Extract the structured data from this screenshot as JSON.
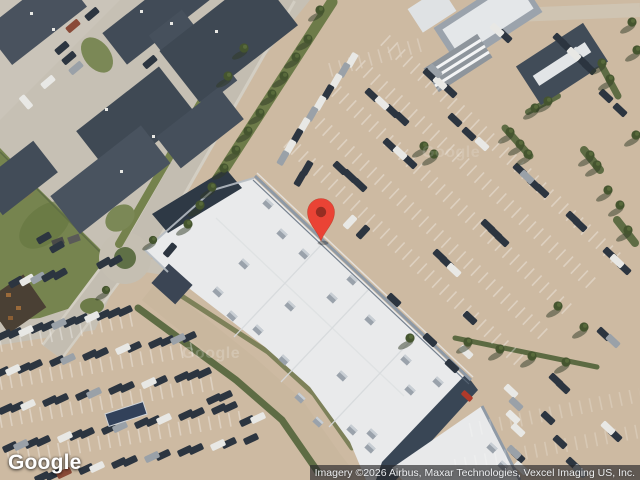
{
  "map": {
    "logo": {
      "text": "Google"
    },
    "watermark_text": "Google",
    "attribution": {
      "text": "Imagery ©2026 Airbus, Maxar Technologies, Vexcel Imaging US, Inc."
    },
    "marker": {
      "fill": "#EA4335",
      "dot": "#962D22"
    },
    "palette": {
      "ground": "#CDBAA2",
      "concrete": "#C6C0B4",
      "road": "#C3BDB1",
      "grass": "#74824E",
      "roof_dark": "#46505C",
      "warehouse_roof": "#E9EAEB"
    }
  }
}
